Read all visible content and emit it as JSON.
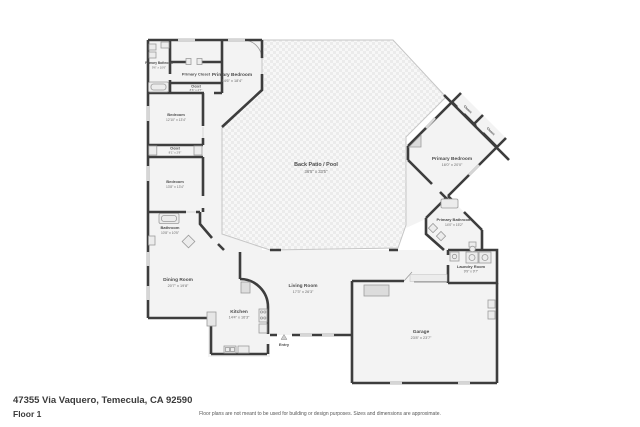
{
  "footer": {
    "address": "47355 Via Vaquero, Temecula, CA 92590",
    "floor_label": "Floor 1",
    "disclaimer": "Floor plans are not meant to be used for building or design purposes. Sizes and dimensions are approximate."
  },
  "colors": {
    "wall": "#3d3d3d",
    "floor": "#f3f3f3",
    "patio_line": "#c6c6c6",
    "fixture": "#ececec",
    "label": "#4c4c4c"
  },
  "rooms": [
    {
      "name": "Primary Bathroom",
      "dims": "9'6\" x 10'6\""
    },
    {
      "name": "Primary Closet",
      "dims": ""
    },
    {
      "name": "Closet",
      "dims": "8'6\" x 2'7\""
    },
    {
      "name": "Primary Bedroom",
      "dims": "14'6\" x 18'4\""
    },
    {
      "name": "Bedroom",
      "dims": "12'10\" x 13'4\""
    },
    {
      "name": "Closet",
      "dims": "8'1\" x 2'8\""
    },
    {
      "name": "Bedroom",
      "dims": "13'8\" x 13'4\""
    },
    {
      "name": "Bathroom",
      "dims": "10'8\" x 10'5\""
    },
    {
      "name": "Back Patio / Pool",
      "dims": "36'5\" x 33'5\""
    },
    {
      "name": "Primary Bedroom",
      "dims": "16'0\" x 20'0\""
    },
    {
      "name": "Closet",
      "dims": ""
    },
    {
      "name": "Closet",
      "dims": ""
    },
    {
      "name": "Primary Bathroom",
      "dims": "14'0\" x 15'2\""
    },
    {
      "name": "Laundry Room",
      "dims": "9'9\" x 9'7\""
    },
    {
      "name": "Dining Room",
      "dims": "20'7\" x 19'8\""
    },
    {
      "name": "Kitchen",
      "dims": "14'4\" x 16'3\""
    },
    {
      "name": "Living Room",
      "dims": "17'3\" x 26'3\""
    },
    {
      "name": "Entry",
      "dims": ""
    },
    {
      "name": "Garage",
      "dims": "23'8\" x 23'7\""
    }
  ]
}
